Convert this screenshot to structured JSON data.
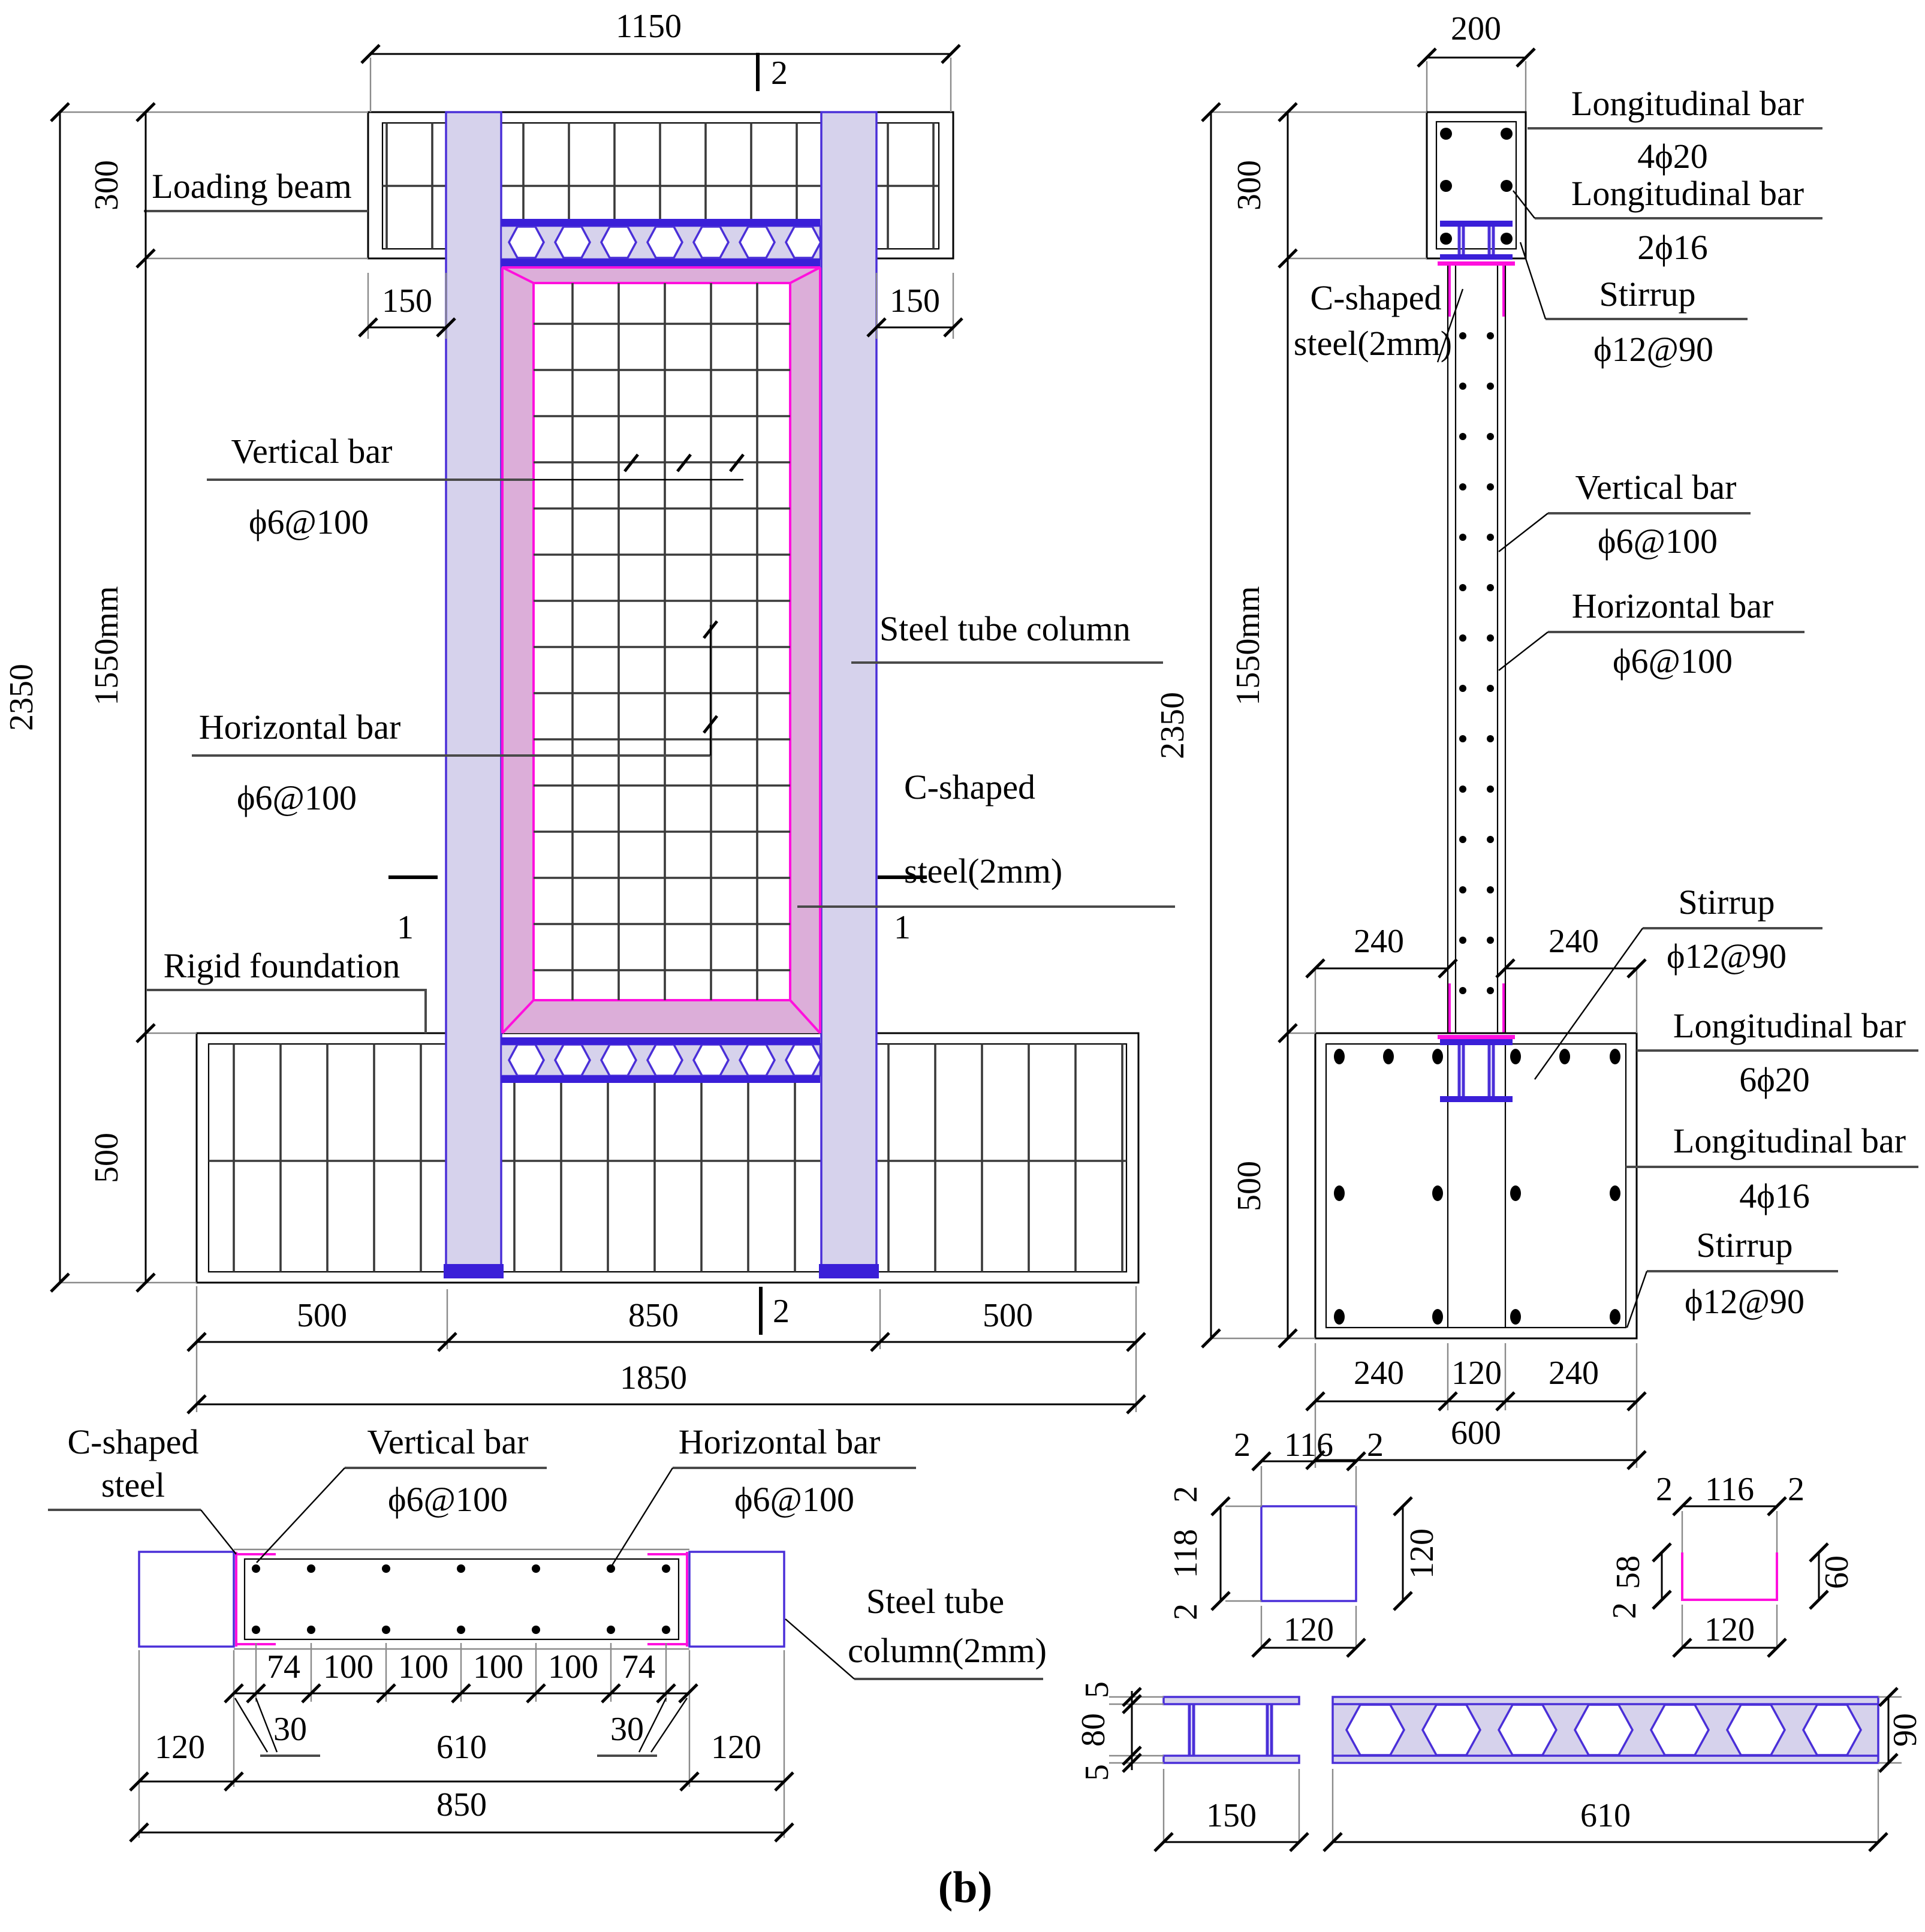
{
  "figure_label": "(b)",
  "colors": {
    "steel_outline": "#4a2fd8",
    "steel_fill_lavender": "#d6d2ec",
    "dark_blue_band": "#3a1fd8",
    "magenta": "#ff10dd",
    "pink_fill": "#dcaed9",
    "grid_line": "#3a3a3a"
  },
  "left_view": {
    "dim_top_width": "1150",
    "marker_top": "2",
    "loading_beam": "Loading beam",
    "dim_overhang_left": "150",
    "dim_overhang_right": "150",
    "dim_beam_height": "300",
    "dim_wall_height": "1550mm",
    "dim_total_height": "2350",
    "dim_found_height": "500",
    "vertical_bar": "Vertical bar",
    "vertical_bar_spec": "ϕ6@100",
    "steel_tube_column": "Steel tube column",
    "c_shaped_1": "C-shaped",
    "c_shaped_2": "steel(2mm)",
    "horizontal_bar": "Horizontal bar",
    "horizontal_bar_spec": "ϕ6@100",
    "rigid_foundation": "Rigid foundation",
    "marker_1_left": "1",
    "marker_1_right": "1",
    "dim_bot_left": "500",
    "dim_bot_mid": "850",
    "marker_bottom": "2",
    "dim_bot_right": "500",
    "dim_total_width": "1850"
  },
  "right_view": {
    "dim_top": "200",
    "long_bar_1": "Longitudinal bar",
    "long_bar_1_spec": "4ϕ20",
    "long_bar_2": "Longitudinal bar",
    "long_bar_2_spec": "2ϕ16",
    "stirrup_top": "Stirrup",
    "stirrup_top_spec": "ϕ12@90",
    "c_shaped_1": "C-shaped",
    "c_shaped_2": "steel(2mm)",
    "vertical_bar": "Vertical bar",
    "vertical_bar_spec": "ϕ6@100",
    "horizontal_bar": "Horizontal bar",
    "horizontal_bar_spec": "ϕ6@100",
    "dim_beam_height": "300",
    "dim_wall_height": "1550mm",
    "dim_total_height": "2350",
    "dim_found_height": "500",
    "dim_240_left": "240",
    "dim_240_right": "240",
    "stirrup_mid": "Stirrup",
    "stirrup_mid_spec": "ϕ12@90",
    "long_bar_3": "Longitudinal bar",
    "long_bar_3_spec": "6ϕ20",
    "long_bar_4": "Longitudinal bar",
    "long_bar_4_spec": "4ϕ16",
    "stirrup_bot": "Stirrup",
    "stirrup_bot_spec": "ϕ12@90",
    "dim_bot_1": "240",
    "dim_bot_2": "120",
    "dim_bot_3": "240",
    "dim_bot_total": "600"
  },
  "plan_view": {
    "c_shaped_1": "C-shaped",
    "c_shaped_2": "steel",
    "vertical_bar": "Vertical bar",
    "vertical_bar_spec": "ϕ6@100",
    "horizontal_bar": "Horizontal bar",
    "horizontal_bar_spec": "ϕ6@100",
    "steel_tube_1": "Steel tube",
    "steel_tube_2": "column(2mm)",
    "dim_74_l": "74",
    "dim_100_1": "100",
    "dim_100_2": "100",
    "dim_100_3": "100",
    "dim_100_4": "100",
    "dim_74_r": "74",
    "dim_30_left": "30",
    "dim_30_right": "30",
    "dim_120_left": "120",
    "dim_610": "610",
    "dim_120_right": "120",
    "dim_850": "850"
  },
  "details": {
    "square_tube": {
      "top_l": "2",
      "top_m": "116",
      "top_r": "2",
      "left_t": "2",
      "left_m": "118",
      "left_b": "2",
      "right": "120",
      "bottom": "120"
    },
    "channel": {
      "top_l": "2",
      "top_m": "116",
      "top_r": "2",
      "left_t": "58",
      "left_b": "2",
      "right": "60",
      "bottom": "120"
    },
    "ibeam": {
      "left_t": "5",
      "left_m": "80",
      "left_b": "5",
      "bottom": "150"
    },
    "slab": {
      "right": "90",
      "bottom": "610"
    }
  }
}
